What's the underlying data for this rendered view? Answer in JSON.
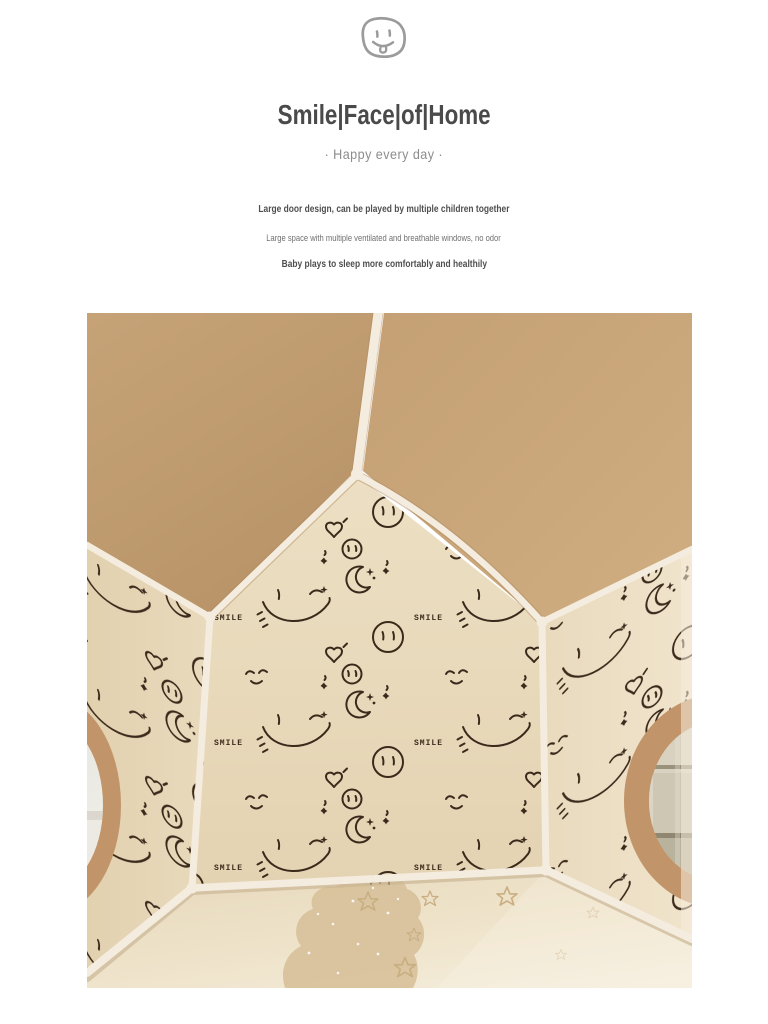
{
  "page": {
    "background": "#ffffff"
  },
  "header": {
    "icon": "tongue-out-smiley-icon",
    "title": "Smile|Face|of|Home",
    "subtitle": "·  Happy every day  ·"
  },
  "features": [
    "Large door design, can be played by multiple children together",
    "Large space with multiple ventilated and breathable windows, no odor",
    "Baby plays to sleep more comfortably and healthily"
  ],
  "photo": {
    "pattern_text": "SMILE",
    "colors": {
      "roof": "#c2a073",
      "wall": "#e8d9bb",
      "doodles": "#3b2a1c",
      "frame_poles": "#f4ecde",
      "window_rim": "#c2946a",
      "floor": "#eee2c8",
      "floor_cloud": "#d8c19b"
    }
  }
}
